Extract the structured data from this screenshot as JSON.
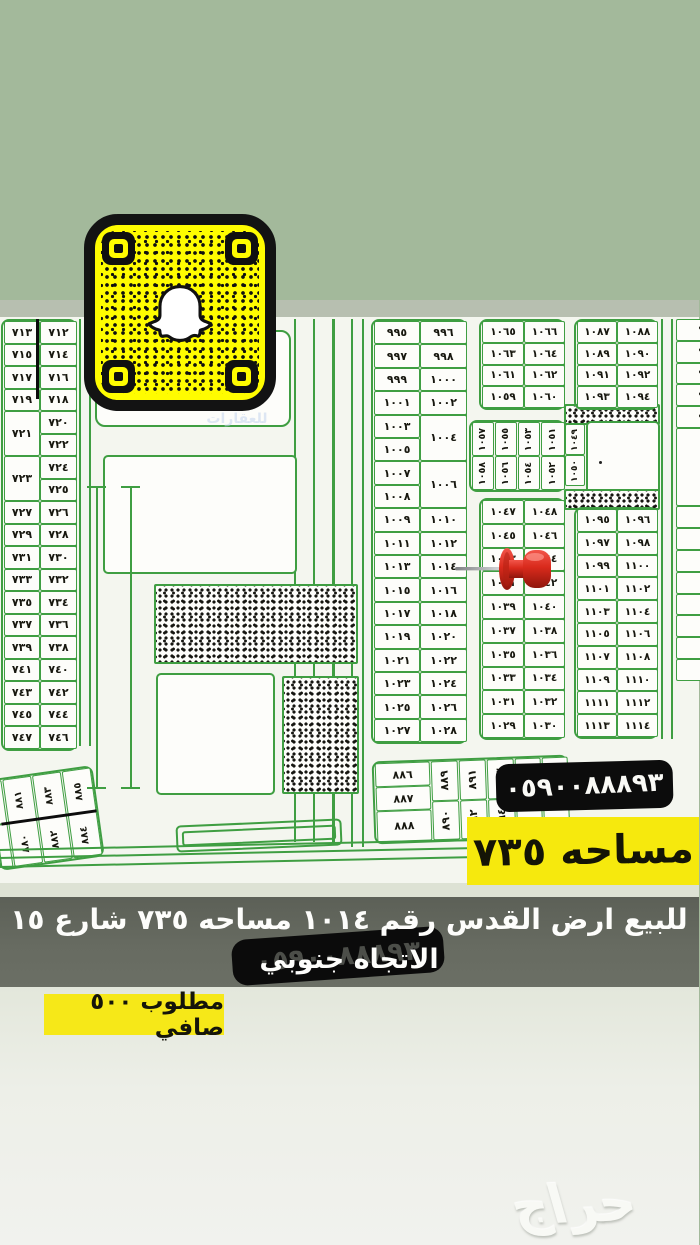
{
  "colors": {
    "background_sage": "#a3b99b",
    "map_background": "#f4f6ef",
    "map_line_green": "#3f9e42",
    "snap_yellow": "#fffc00",
    "highlight_yellow": "#f6e90d",
    "pill_black": "#0c0c0c",
    "banner_gray": "#63675d",
    "pin_red": "#d92a1c"
  },
  "listing": {
    "phone": "٠٥٩٠٠٨٨٨٩٣",
    "area_label": "مساحه ٧٣٥",
    "banner_line1": "للبيع ارض القدس رقم ١٠١٤ مساحه ٧٣٥ شارع ١٥",
    "banner_line2": "الاتجاه جنوبي",
    "price_label": "مطلوب ٥٠٠ صافي",
    "haraj_watermark": "حراج",
    "agency_watermark": "للعقارات"
  },
  "map": {
    "pinned_plot": "١٠١٤",
    "blocks": [
      {
        "name": "left-plots",
        "x": 2,
        "y": 319,
        "w": 76,
        "unit": 22.5,
        "fs": 11,
        "cols": [
          {
            "x": 1,
            "w": 36,
            "cells": [
              [
                "٧١٣",
                1
              ],
              [
                "٧١٥",
                1
              ],
              [
                "٧١٧",
                1
              ],
              [
                "٧١٩",
                1
              ],
              [
                "٧٢١",
                2
              ],
              [
                "٧٢٣",
                2
              ],
              [
                "٧٢٧",
                1
              ],
              [
                "٧٢٩",
                1
              ],
              [
                "٧٣١",
                1
              ],
              [
                "٧٣٣",
                1
              ],
              [
                "٧٣٥",
                1
              ],
              [
                "٧٣٧",
                1
              ],
              [
                "٧٣٩",
                1
              ],
              [
                "٧٤١",
                1
              ],
              [
                "٧٤٣",
                1
              ],
              [
                "٧٤٥",
                1
              ],
              [
                "٧٤٧",
                1
              ]
            ]
          },
          {
            "x": 37,
            "w": 37,
            "cells": [
              [
                "٧١٢",
                1
              ],
              [
                "٧١٤",
                1
              ],
              [
                "٧١٦",
                1
              ],
              [
                "٧١٨",
                1
              ],
              [
                "٧٢٠",
                1
              ],
              [
                "٧٢٢",
                1
              ],
              [
                "٧٢٤",
                1
              ],
              [
                "٧٢٥",
                1
              ],
              [
                "٧٢٦",
                1
              ],
              [
                "٧٢٨",
                1
              ],
              [
                "٧٣٠",
                1
              ],
              [
                "٧٣٢",
                1
              ],
              [
                "٧٣٤",
                1
              ],
              [
                "٧٣٦",
                1
              ],
              [
                "٧٣٨",
                1
              ],
              [
                "٧٤٠",
                1
              ],
              [
                "٧٤٢",
                1
              ],
              [
                "٧٤٤",
                1
              ],
              [
                "٧٤٦",
                1
              ]
            ]
          }
        ]
      },
      {
        "name": "center-plots",
        "x": 372,
        "y": 319,
        "w": 96,
        "unit": 23.4,
        "fs": 11,
        "cols": [
          {
            "x": 1,
            "w": 46,
            "cells": [
              [
                "٩٩٥",
                1
              ],
              [
                "٩٩٧",
                1
              ],
              [
                "٩٩٩",
                1
              ],
              [
                "١٠٠١",
                1
              ],
              [
                "١٠٠٣",
                1
              ],
              [
                "١٠٠٥",
                1
              ],
              [
                "١٠٠٧",
                1
              ],
              [
                "١٠٠٨",
                1
              ],
              [
                "١٠٠٩",
                1
              ],
              [
                "١٠١١",
                1
              ],
              [
                "١٠١٣",
                1
              ],
              [
                "١٠١٥",
                1
              ],
              [
                "١٠١٧",
                1
              ],
              [
                "١٠١٩",
                1
              ],
              [
                "١٠٢١",
                1
              ],
              [
                "١٠٢٣",
                1
              ],
              [
                "١٠٢٥",
                1
              ],
              [
                "١٠٢٧",
                1
              ]
            ]
          },
          {
            "x": 47,
            "w": 47,
            "cells": [
              [
                "٩٩٦",
                1
              ],
              [
                "٩٩٨",
                1
              ],
              [
                "١٠٠٠",
                1
              ],
              [
                "١٠٠٢",
                1
              ],
              [
                "١٠٠٤",
                2
              ],
              [
                "١٠٠٦",
                2
              ],
              [
                "١٠١٠",
                1
              ],
              [
                "١٠١٢",
                1
              ],
              [
                "١٠١٤",
                1
              ],
              [
                "١٠١٦",
                1
              ],
              [
                "١٠١٨",
                1
              ],
              [
                "١٠٢٠",
                1
              ],
              [
                "١٠٢٢",
                1
              ],
              [
                "١٠٢٤",
                1
              ],
              [
                "١٠٢٦",
                1
              ],
              [
                "١٠٢٨",
                1
              ]
            ]
          }
        ]
      },
      {
        "name": "block-1059-1066",
        "x": 480,
        "y": 319,
        "w": 86,
        "unit": 21.8,
        "fs": 10.5,
        "cols": [
          {
            "x": 1,
            "w": 42,
            "cells": [
              [
                "١٠٦٥",
                1
              ],
              [
                "١٠٦٣",
                1
              ],
              [
                "١٠٦١",
                1
              ],
              [
                "١٠٥٩",
                1
              ]
            ]
          },
          {
            "x": 43,
            "w": 41,
            "cells": [
              [
                "١٠٦٦",
                1
              ],
              [
                "١٠٦٤",
                1
              ],
              [
                "١٠٦٢",
                1
              ],
              [
                "١٠٦٠",
                1
              ]
            ]
          }
        ]
      },
      {
        "name": "sideways-1051-1058",
        "x": 470,
        "y": 420,
        "w": 96,
        "unit": 34,
        "fs": 9.5,
        "text_rotate": true,
        "cols": [
          {
            "x": 1,
            "w": 22,
            "cells": [
              [
                "١٠٥٧",
                1
              ],
              [
                "١٠٥٨",
                1
              ]
            ]
          },
          {
            "x": 24,
            "w": 22,
            "cells": [
              [
                "١٠٥٥",
                1
              ],
              [
                "١٠٥٦",
                1
              ]
            ]
          },
          {
            "x": 47,
            "w": 22,
            "cells": [
              [
                "١٠٥٣",
                1
              ],
              [
                "١٠٥٤",
                1
              ]
            ]
          },
          {
            "x": 70,
            "w": 24,
            "cells": [
              [
                "١٠٥١",
                1
              ],
              [
                "١٠٥٢",
                1
              ]
            ]
          }
        ]
      },
      {
        "name": "pin-block-1029-1048",
        "x": 480,
        "y": 498,
        "w": 86,
        "unit": 23.8,
        "fs": 10.5,
        "cols": [
          {
            "x": 1,
            "w": 42,
            "cells": [
              [
                "١٠٤٧",
                1
              ],
              [
                "١٠٤٥",
                1
              ],
              [
                "١٠٤٣",
                1
              ],
              [
                "١٠٤١",
                1
              ],
              [
                "١٠٣٩",
                1
              ],
              [
                "١٠٣٧",
                1
              ],
              [
                "١٠٣٥",
                1
              ],
              [
                "١٠٣٣",
                1
              ],
              [
                "١٠٣١",
                1
              ],
              [
                "١٠٢٩",
                1
              ]
            ]
          },
          {
            "x": 43,
            "w": 41,
            "cells": [
              [
                "١٠٤٨",
                1
              ],
              [
                "١٠٤٦",
                1
              ],
              [
                "١٠٤٤",
                1
              ],
              [
                "١٠٤٢",
                1
              ],
              [
                "١٠٤٠",
                1
              ],
              [
                "١٠٣٨",
                1
              ],
              [
                "١٠٣٦",
                1
              ],
              [
                "١٠٣٤",
                1
              ],
              [
                "١٠٣٢",
                1
              ],
              [
                "١٠٣٠",
                1
              ]
            ]
          }
        ]
      },
      {
        "name": "right-plots-upper",
        "x": 575,
        "y": 319,
        "w": 84,
        "unit": 21.8,
        "fs": 10.5,
        "cols": [
          {
            "x": 1,
            "w": 40,
            "cells": [
              [
                "١٠٨٧",
                1
              ],
              [
                "١٠٨٩",
                1
              ],
              [
                "١٠٩١",
                1
              ],
              [
                "١٠٩٣",
                1
              ]
            ]
          },
          {
            "x": 41,
            "w": 41,
            "cells": [
              [
                "١٠٨٨",
                1
              ],
              [
                "١٠٩٠",
                1
              ],
              [
                "١٠٩٢",
                1
              ],
              [
                "١٠٩٤",
                1
              ]
            ]
          }
        ]
      },
      {
        "name": "mosque-labels",
        "x": 566,
        "y": 424,
        "w": 21,
        "unit": 31,
        "fs": 9,
        "text_rotate": true,
        "frame": false,
        "cols": [
          {
            "x": 0,
            "w": 20,
            "cells": [
              [
                "١٠٤٩",
                1
              ],
              [
                "١٠٥٠",
                1
              ]
            ]
          }
        ]
      },
      {
        "name": "right-plots-lower",
        "x": 575,
        "y": 507,
        "w": 84,
        "unit": 22.8,
        "fs": 10.5,
        "cols": [
          {
            "x": 1,
            "w": 40,
            "cells": [
              [
                "١٠٩٥",
                1
              ],
              [
                "١٠٩٧",
                1
              ],
              [
                "١٠٩٩",
                1
              ],
              [
                "١١٠١",
                1
              ],
              [
                "١١٠٣",
                1
              ],
              [
                "١١٠٥",
                1
              ],
              [
                "١١٠٧",
                1
              ],
              [
                "١١٠٩",
                1
              ],
              [
                "١١١١",
                1
              ],
              [
                "١١١٣",
                1
              ]
            ]
          },
          {
            "x": 41,
            "w": 41,
            "cells": [
              [
                "١٠٩٦",
                1
              ],
              [
                "١٠٩٨",
                1
              ],
              [
                "١١٠٠",
                1
              ],
              [
                "١١٠٢",
                1
              ],
              [
                "١١٠٤",
                1
              ],
              [
                "١١٠٦",
                1
              ],
              [
                "١١٠٨",
                1
              ],
              [
                "١١١٠",
                1
              ],
              [
                "١١١٢",
                1
              ],
              [
                "١١١٤",
                1
              ]
            ]
          }
        ]
      },
      {
        "name": "edge-partial-plots",
        "x": 677,
        "y": 319,
        "w": 40,
        "unit": 21.8,
        "fs": 11,
        "frame": false,
        "clip": true,
        "cols": [
          {
            "x": 0,
            "w": 40,
            "cells": [
              [
                "٩٤",
                1
              ],
              [
                "٩٠",
                1
              ],
              [
                "٩١",
                1
              ],
              [
                "٩١",
                1
              ],
              [
                "٩١",
                1
              ],
              [
                "",
                3.6
              ],
              [
                "٩",
                1
              ],
              [
                "٩",
                1
              ],
              [
                "٩",
                1
              ],
              [
                "٩",
                1
              ],
              [
                "٩",
                1
              ],
              [
                "٩",
                1
              ],
              [
                "٩",
                1
              ],
              [
                "٩",
                1
              ]
            ]
          }
        ]
      },
      {
        "name": "bottom-strip-plots",
        "x": 374,
        "y": 758,
        "w": 196,
        "unit": 24,
        "fs": 11,
        "rotate": -2,
        "cols": [
          {
            "x": 1,
            "w": 55,
            "cells": [
              [
                "٨٨٦",
                1
              ],
              [
                "٨٨٧",
                1
              ],
              [
                "٨٨٨",
                1.3
              ]
            ]
          },
          {
            "x": 57,
            "w": 27,
            "rot": true,
            "cells": [
              [
                "٨٨٩",
                1.65
              ],
              [
                "٨٩٠",
                1.65
              ]
            ]
          },
          {
            "x": 85,
            "w": 27,
            "rot": true,
            "cells": [
              [
                "٨٩١",
                1.65
              ],
              [
                "٨٩٢",
                1.65
              ]
            ]
          },
          {
            "x": 113,
            "w": 27,
            "rot": true,
            "cells": [
              [
                "٨٩٣",
                1.65
              ],
              [
                "٨٩٤",
                1.65
              ]
            ]
          },
          {
            "x": 141,
            "w": 26,
            "rot": true,
            "cells": [
              [
                "",
                1.65
              ],
              [
                "",
                1.65
              ]
            ]
          },
          {
            "x": 168,
            "w": 26,
            "rot": true,
            "cells": [
              [
                "",
                1.65
              ],
              [
                "",
                1.65
              ]
            ]
          }
        ]
      },
      {
        "name": "bottom-left-plots",
        "x": -6,
        "y": 772,
        "w": 106,
        "unit": 44,
        "fs": 10,
        "rotate": -8,
        "text_rotate": true,
        "cols": [
          {
            "x": 0,
            "w": 12,
            "cells": [
              [
                "",
                1
              ],
              [
                "",
                1
              ]
            ]
          },
          {
            "x": 13,
            "w": 29,
            "cells": [
              [
                "٨٨١",
                1
              ],
              [
                "٨٨٠",
                1
              ]
            ]
          },
          {
            "x": 43,
            "w": 29,
            "cells": [
              [
                "٨٨٣",
                1
              ],
              [
                "٨٨٢",
                1
              ]
            ]
          },
          {
            "x": 73,
            "w": 29,
            "cells": [
              [
                "٨٨٥",
                1
              ],
              [
                "٨٨٤",
                1
              ]
            ]
          }
        ]
      }
    ]
  }
}
